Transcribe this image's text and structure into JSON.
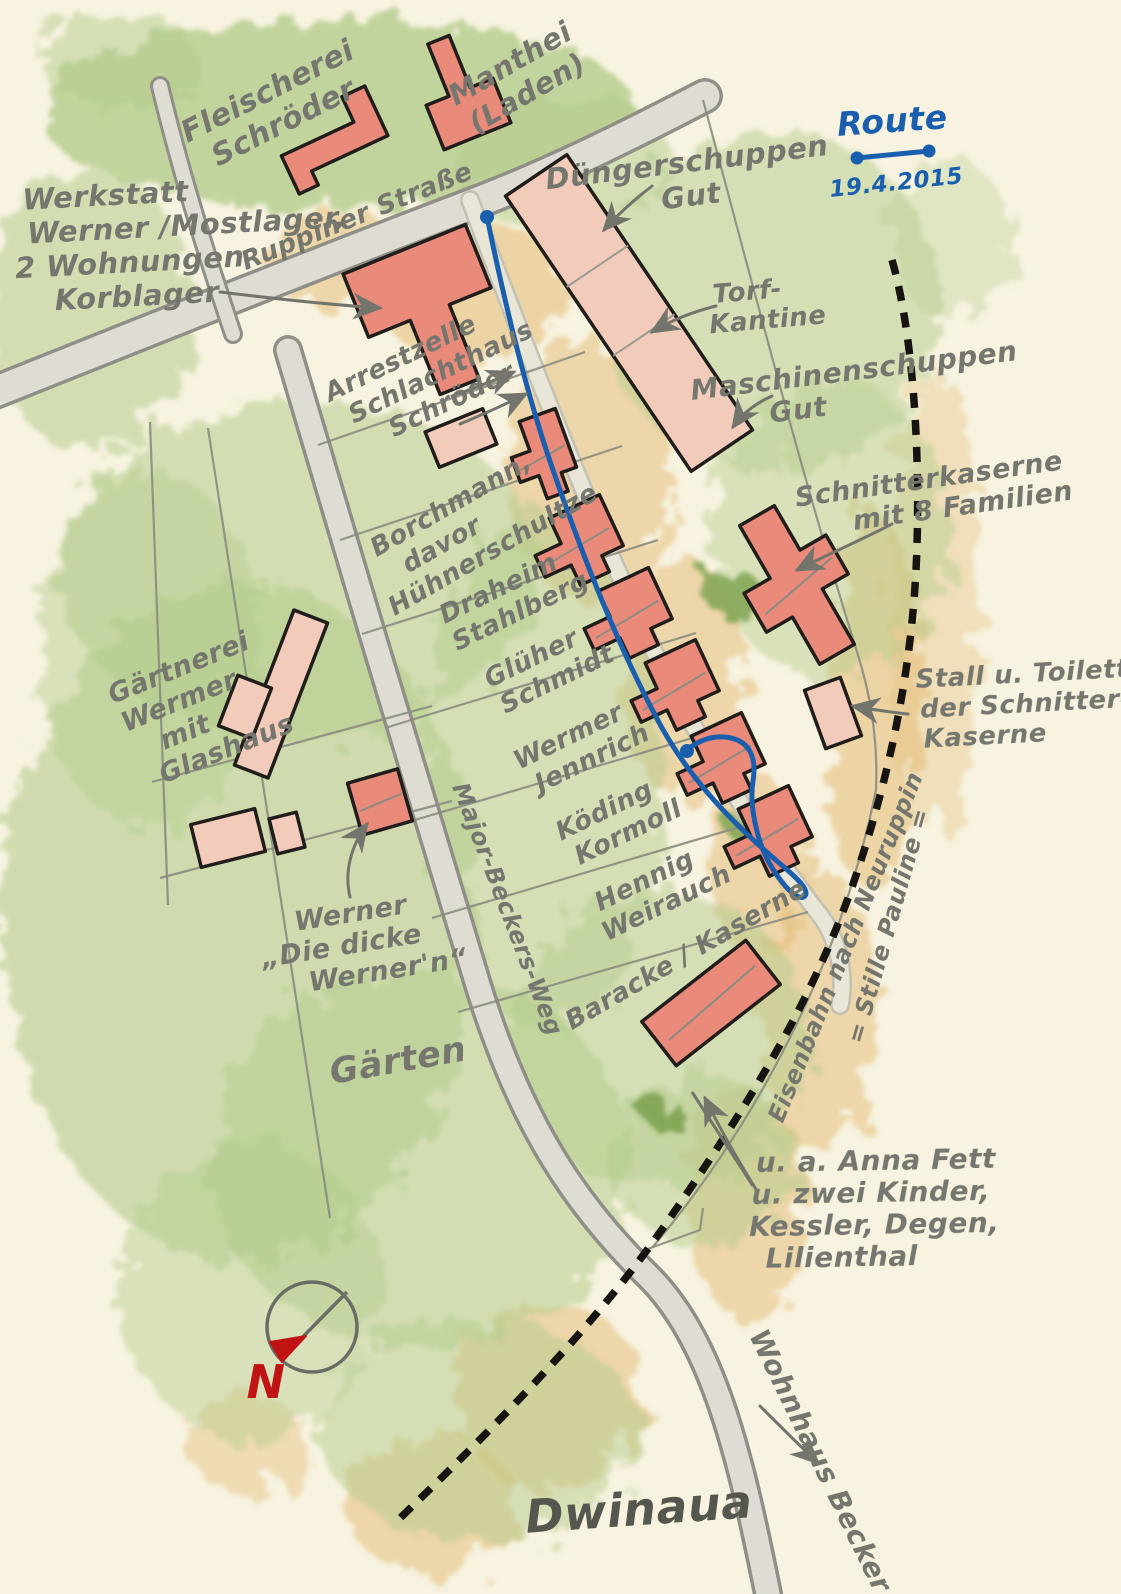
{
  "palette": {
    "paper": "#f7f3e0",
    "ink": "#75776f",
    "ink_dark": "#55574f",
    "blue": "#1a5fae",
    "red_pen": "#c01414",
    "outline": "#201d1a",
    "red": "#e98a7b",
    "pale": "#f2cbbb",
    "road_edge": "#8f8f88",
    "road_fill": "#dedcd3",
    "lane_edge": "#c2c1b3",
    "lane_fill": "#e9e6d8",
    "boundary": "#8a8c80",
    "rail": "#161310",
    "green": "#b4cc8c",
    "green_dark": "#7fa352",
    "tan": "#e3ba72",
    "arrow": "#73756d"
  },
  "legend": {
    "title": "Route",
    "date": "19.4.2015",
    "line": {
      "x1": 857,
      "y1": 158,
      "x2": 929,
      "y2": 151,
      "dot_r": 6.5
    }
  },
  "compass": {
    "cx": 312,
    "cy": 1327,
    "r": 45,
    "needle": {
      "x1": 347,
      "y1": 1292,
      "x2": 286,
      "y2": 1354
    },
    "arrowhead": "306,1336 282,1362 270,1342",
    "north_label": "N"
  },
  "labels": [
    {
      "id": "fleischerei",
      "lines": [
        "Fleischerei",
        "Schröder"
      ],
      "x": 272,
      "y": 100,
      "rot": -27,
      "size": 30
    },
    {
      "id": "manthei",
      "lines": [
        "Manthei",
        "(Laden)"
      ],
      "x": 515,
      "y": 72,
      "rot": -30,
      "size": 29
    },
    {
      "id": "werkstatt",
      "lines": [
        "Werkstatt",
        "Werner /Mostlager,",
        "2 Wohnungen",
        "Korblager"
      ],
      "x": 18,
      "y": 210,
      "rot": -3,
      "size": 29,
      "anchor": "start",
      "dxs": [
        5,
        8,
        -6,
        32
      ]
    },
    {
      "id": "ruppiner-strasse",
      "lines": [
        "Ruppiner Straße"
      ],
      "x": 360,
      "y": 224,
      "rot": -22,
      "size": 26
    },
    {
      "id": "duengerschuppen",
      "lines": [
        "Düngerschuppen",
        "Gut"
      ],
      "x": 688,
      "y": 172,
      "rot": -7,
      "size": 29
    },
    {
      "id": "torf-kantine",
      "lines": [
        "Torf-",
        "Kantine"
      ],
      "x": 748,
      "y": 300,
      "rot": -5,
      "size": 26,
      "dxs": [
        0,
        18
      ]
    },
    {
      "id": "maschinenschuppen",
      "lines": [
        "Maschinenschuppen",
        "Gut"
      ],
      "x": 855,
      "y": 380,
      "rot": -7,
      "size": 28,
      "dxs": [
        0,
        -60
      ]
    },
    {
      "id": "arrestzelle",
      "lines": [
        "Arrestzelle",
        "Schlachthaus",
        "Schröder"
      ],
      "x": 330,
      "y": 402,
      "rot": -26,
      "size": 26,
      "anchor": "start",
      "dxs": [
        0,
        12,
        42
      ]
    },
    {
      "id": "borchmann",
      "lines": [
        "Borchmann,",
        "davor",
        "Hühnerschultze"
      ],
      "x": 455,
      "y": 512,
      "rot": -30,
      "size": 26,
      "dxs": [
        0,
        -28,
        14
      ]
    },
    {
      "id": "draheim-stahlberg",
      "lines": [
        "Draheim",
        "Stahlberg"
      ],
      "x": 502,
      "y": 596,
      "rot": -26,
      "size": 26,
      "dxs": [
        0,
        10
      ]
    },
    {
      "id": "glueher-schmidt",
      "lines": [
        "Glüher",
        "Schmidt"
      ],
      "x": 535,
      "y": 666,
      "rot": -26,
      "size": 26,
      "dxs": [
        0,
        14
      ]
    },
    {
      "id": "wermer-jennrich",
      "lines": [
        "Wermer",
        "Jennrich"
      ],
      "x": 572,
      "y": 744,
      "rot": -26,
      "size": 26,
      "dxs": [
        0,
        12
      ]
    },
    {
      "id": "koeding-kormoll",
      "lines": [
        "Köding",
        "Kormoll"
      ],
      "x": 608,
      "y": 818,
      "rot": -26,
      "size": 26,
      "dxs": [
        0,
        12
      ]
    },
    {
      "id": "hennig-weirauch",
      "lines": [
        "Hennig",
        "Weirauch"
      ],
      "x": 648,
      "y": 888,
      "rot": -26,
      "size": 26,
      "dxs": [
        0,
        10
      ]
    },
    {
      "id": "baracke-kaserne",
      "lines": [
        "Baracke / Kaserne"
      ],
      "x": 690,
      "y": 962,
      "rot": -30,
      "size": 26
    },
    {
      "id": "schnitterkaserne",
      "lines": [
        "Schnitterkaserne",
        "mit 8 Familien"
      ],
      "x": 930,
      "y": 488,
      "rot": -8,
      "size": 27,
      "dxs": [
        0,
        30
      ]
    },
    {
      "id": "stall-toiletten",
      "lines": [
        "Stall u. Toiletten",
        "der Schnitter-",
        "Kaserne"
      ],
      "x": 916,
      "y": 688,
      "rot": -3,
      "size": 26,
      "anchor": "start",
      "dxs": [
        0,
        3,
        5
      ]
    },
    {
      "id": "gaertnerei",
      "lines": [
        "Gärtnerei",
        "Wermer",
        "mit",
        "Glashaus"
      ],
      "x": 182,
      "y": 676,
      "rot": -22,
      "size": 27,
      "dxs": [
        0,
        -12,
        -18,
        14
      ]
    },
    {
      "id": "dicke-wernern",
      "lines": [
        "Werner",
        "„Die dicke",
        "Werner'n“"
      ],
      "x": 352,
      "y": 922,
      "rot": -9,
      "size": 27,
      "dxs": [
        0,
        -14,
        28
      ]
    },
    {
      "id": "gaerten",
      "lines": [
        "Gärten"
      ],
      "x": 400,
      "y": 1072,
      "rot": -10,
      "size": 35
    },
    {
      "id": "major-beckers-weg",
      "lines": [
        "Major-Beckers-Weg"
      ],
      "x": 500,
      "y": 912,
      "rot": 69,
      "size": 24
    },
    {
      "id": "eisenbahn",
      "lines": [
        "Eisenbahn nach Neuruppin"
      ],
      "x": 853,
      "y": 950,
      "rot": -68,
      "size": 24
    },
    {
      "id": "stille-pauline",
      "lines": [
        "= Stille Pauline ="
      ],
      "x": 896,
      "y": 928,
      "rot": -74,
      "size": 24
    },
    {
      "id": "anna-fett",
      "lines": [
        "u. a. Anna Fett",
        "u. zwei Kinder,",
        "Kessler, Degen,",
        "Lilienthal"
      ],
      "x": 748,
      "y": 1172,
      "rot": -1,
      "size": 28,
      "anchor": "start",
      "dxs": [
        8,
        3,
        0,
        16
      ]
    },
    {
      "id": "wohnhaus-becker",
      "lines": [
        "Wohnhaus Becker"
      ],
      "x": 812,
      "y": 1465,
      "rot": 64,
      "size": 28
    },
    {
      "id": "dwinaua",
      "lines": [
        "Dwinaua"
      ],
      "x": 640,
      "y": 1525,
      "rot": -4,
      "size": 46,
      "color": "#55574f"
    },
    {
      "id": "route-title",
      "lines": [
        "Route"
      ],
      "x": 893,
      "y": 132,
      "rot": -4,
      "size": 33,
      "color": "#1a5fae"
    },
    {
      "id": "route-date",
      "lines": [
        "19.4.2015"
      ],
      "x": 897,
      "y": 190,
      "rot": -6,
      "size": 23,
      "color": "#1a5fae"
    },
    {
      "id": "compass-n",
      "lines": [
        "N"
      ],
      "x": 266,
      "y": 1398,
      "rot": 0,
      "size": 46,
      "color": "#c01414"
    }
  ],
  "shapes": {
    "rect": [
      [
        -0.5,
        -0.5
      ],
      [
        0.5,
        -0.5
      ],
      [
        0.5,
        0.5
      ],
      [
        -0.5,
        0.5
      ]
    ],
    "lhouse": [
      [
        -0.5,
        -0.12
      ],
      [
        -0.16,
        -0.12
      ],
      [
        -0.16,
        -0.5
      ],
      [
        0.5,
        -0.5
      ],
      [
        0.5,
        0.26
      ],
      [
        0.22,
        0.26
      ],
      [
        0.22,
        0.5
      ],
      [
        -0.16,
        0.5
      ],
      [
        -0.16,
        0.2
      ],
      [
        -0.5,
        0.2
      ]
    ],
    "tee": [
      [
        -0.5,
        -0.5
      ],
      [
        0.5,
        -0.5
      ],
      [
        0.5,
        -0.04
      ],
      [
        0.16,
        -0.04
      ],
      [
        0.16,
        0.5
      ],
      [
        -0.16,
        0.5
      ],
      [
        -0.16,
        -0.04
      ],
      [
        -0.5,
        -0.04
      ]
    ],
    "cross": [
      [
        -0.2,
        -0.5
      ],
      [
        0.2,
        -0.5
      ],
      [
        0.2,
        -0.18
      ],
      [
        0.5,
        -0.18
      ],
      [
        0.5,
        0.1
      ],
      [
        0.2,
        0.1
      ],
      [
        0.2,
        0.5
      ],
      [
        -0.2,
        0.5
      ],
      [
        -0.2,
        0.16
      ],
      [
        -0.5,
        0.16
      ],
      [
        -0.5,
        -0.12
      ],
      [
        -0.2,
        -0.12
      ]
    ],
    "barstep": [
      [
        -0.5,
        -0.1
      ],
      [
        0.26,
        -0.1
      ],
      [
        0.26,
        -0.5
      ],
      [
        0.5,
        -0.5
      ],
      [
        0.5,
        0.28
      ],
      [
        -0.3,
        0.28
      ],
      [
        -0.3,
        0.5
      ],
      [
        -0.5,
        0.5
      ]
    ]
  },
  "buildings": [
    {
      "id": "fleischerei-schroeder",
      "shape": "barstep",
      "cx": 332,
      "cy": 140,
      "w": 105,
      "h": 70,
      "rot": -25,
      "tone": "red"
    },
    {
      "id": "manthei-laden",
      "shape": "tee",
      "cx": 458,
      "cy": 88,
      "w": 72,
      "h": 104,
      "rot": 158,
      "tone": "red"
    },
    {
      "id": "werkstatt-schlachthaus",
      "shape": "tee",
      "cx": 432,
      "cy": 318,
      "w": 132,
      "h": 148,
      "rot": -22,
      "tone": "red"
    },
    {
      "id": "duengerschuppen-gut",
      "shape": "rect",
      "cx": 629,
      "cy": 313,
      "w": 74,
      "h": 332,
      "rot": -34,
      "tone": "pale",
      "partitions": [
        0.33,
        0.58
      ]
    },
    {
      "id": "huehner-shed",
      "shape": "rect",
      "cx": 461,
      "cy": 438,
      "w": 62,
      "h": 38,
      "rot": -22,
      "tone": "pale"
    },
    {
      "id": "borchmann-haus",
      "shape": "lhouse",
      "cx": 542,
      "cy": 457,
      "w": 58,
      "h": 82,
      "rot": -20,
      "tone": "red",
      "ridge": true
    },
    {
      "id": "row-haus-1",
      "shape": "lhouse",
      "cx": 577,
      "cy": 546,
      "w": 84,
      "h": 74,
      "rot": -25,
      "tone": "red",
      "ridge": true
    },
    {
      "id": "row-haus-2",
      "shape": "lhouse",
      "cx": 626,
      "cy": 619,
      "w": 84,
      "h": 74,
      "rot": -25,
      "tone": "red",
      "ridge": true
    },
    {
      "id": "row-haus-3",
      "shape": "lhouse",
      "cx": 673,
      "cy": 691,
      "w": 84,
      "h": 74,
      "rot": -25,
      "tone": "red",
      "ridge": true
    },
    {
      "id": "row-haus-4",
      "shape": "lhouse",
      "cx": 719,
      "cy": 764,
      "w": 84,
      "h": 74,
      "rot": -25,
      "tone": "red",
      "ridge": true
    },
    {
      "id": "row-haus-5",
      "shape": "lhouse",
      "cx": 766,
      "cy": 837,
      "w": 84,
      "h": 74,
      "rot": -25,
      "tone": "red",
      "ridge": true
    },
    {
      "id": "schnitterkaserne",
      "shape": "cross",
      "cx": 797,
      "cy": 585,
      "w": 100,
      "h": 160,
      "rot": -30,
      "tone": "red",
      "ridge": true
    },
    {
      "id": "stall-toiletten-shed",
      "shape": "rect",
      "cx": 833,
      "cy": 713,
      "w": 38,
      "h": 62,
      "rot": -20,
      "tone": "pale"
    },
    {
      "id": "baracke",
      "shape": "rect",
      "cx": 711,
      "cy": 1003,
      "w": 132,
      "h": 56,
      "rot": -38,
      "tone": "red",
      "ridge": true
    },
    {
      "id": "glashaus",
      "shape": "rect",
      "cx": 281,
      "cy": 694,
      "w": 36,
      "h": 166,
      "rot": 21,
      "tone": "pale"
    },
    {
      "id": "gaertnerei-shed",
      "shape": "rect",
      "cx": 245,
      "cy": 707,
      "w": 36,
      "h": 54,
      "rot": 21,
      "tone": "pale"
    },
    {
      "id": "pale-barn",
      "shape": "rect",
      "cx": 228,
      "cy": 838,
      "w": 66,
      "h": 44,
      "rot": -14,
      "tone": "pale"
    },
    {
      "id": "pale-hut",
      "shape": "rect",
      "cx": 287,
      "cy": 833,
      "w": 28,
      "h": 36,
      "rot": -14,
      "tone": "pale"
    },
    {
      "id": "dicke-werner-haus",
      "shape": "rect",
      "cx": 380,
      "cy": 802,
      "w": 52,
      "h": 54,
      "rot": -16,
      "tone": "red",
      "ridge": true
    }
  ],
  "roads": [
    {
      "id": "ruppiner-strasse",
      "d": "M -20,398 C 150,330 320,262 470,205 C 550,175 630,135 705,96",
      "w_out": 36,
      "w_in": 29
    },
    {
      "id": "nord-stub",
      "d": "M 160,86 C 180,170 205,250 233,334",
      "w_out": 20,
      "w_in": 14
    },
    {
      "id": "major-beckers-weg",
      "d": "M 288,350 C 345,545 425,810 478,985 C 520,1122 575,1205 648,1276 C 715,1342 742,1465 768,1594",
      "w_out": 30,
      "w_in": 23
    },
    {
      "id": "gut-lane",
      "d": "M 470,200 C 515,320 575,475 638,618 C 692,735 758,835 822,918 C 838,940 846,975 840,1005",
      "w_out": 20,
      "w_in": 15,
      "lane": true
    }
  ],
  "boundaries": [
    {
      "id": "plot-1",
      "d": "M 318,445 L 585,352"
    },
    {
      "id": "plot-2",
      "d": "M 340,540 L 622,446"
    },
    {
      "id": "plot-3",
      "d": "M 362,634 L 658,540"
    },
    {
      "id": "plot-4",
      "d": "M 385,728 L 696,633"
    },
    {
      "id": "plot-5",
      "d": "M 408,822 L 733,726"
    },
    {
      "id": "plot-6",
      "d": "M 432,918 L 770,818"
    },
    {
      "id": "plot-7",
      "d": "M 458,1012 L 808,912"
    },
    {
      "id": "garten-quer-1",
      "d": "M 152,782 L 432,706"
    },
    {
      "id": "garten-quer-2",
      "d": "M 160,878 L 452,801"
    },
    {
      "id": "garten-west",
      "d": "M 150,422 L 168,905"
    },
    {
      "id": "garten-lang",
      "d": "M 208,428 L 330,1218"
    },
    {
      "id": "gut-ost",
      "d": "M 703,100 C 745,255 800,470 858,655"
    },
    {
      "id": "gut-ost-2",
      "d": "M 858,655 C 872,700 878,745 876,790"
    },
    {
      "id": "bahn-west",
      "d": "M 876,790 C 842,958 760,1120 652,1248"
    },
    {
      "id": "kreuzung-zacke",
      "d": "M 645,1250 L 700,1230 L 703,1208"
    }
  ],
  "railway": {
    "id": "eisenbahn-gleis",
    "d": "M 892,260 C 912,330 920,440 917,545 C 914,655 893,770 851,890 C 809,1008 744,1112 663,1228 C 595,1325 500,1422 396,1522",
    "width": 7.5,
    "dash": "15 12"
  },
  "route": {
    "d": "M 487,217 C 502,290 525,390 553,470 C 585,563 622,655 662,728 C 698,792 748,836 778,862 C 796,877 810,890 805,896 C 799,902 784,888 771,866 C 757,843 749,805 753,781 C 757,757 749,742 731,738 C 712,734 696,742 687,750",
    "width": 5,
    "start": {
      "x": 487,
      "y": 217,
      "r": 7
    },
    "end": {
      "x": 687,
      "y": 751,
      "r": 7
    }
  },
  "arrows": [
    {
      "id": "werkstatt-arrow",
      "d": "M 220,292 C 285,300 335,305 380,308"
    },
    {
      "id": "arrest-arrow-1",
      "d": "M 452,396 C 475,388 495,380 514,372"
    },
    {
      "id": "arrest-arrow-2",
      "d": "M 460,424 C 484,414 506,404 526,394"
    },
    {
      "id": "duenger-arrow",
      "d": "M 652,186 C 634,200 618,214 604,230"
    },
    {
      "id": "torf-arrow",
      "d": "M 716,306 C 692,312 670,321 652,332"
    },
    {
      "id": "maschinen-arrow",
      "d": "M 772,396 C 754,404 742,414 733,427"
    },
    {
      "id": "schnitter-arrow",
      "d": "M 892,524 C 855,543 820,558 797,570"
    },
    {
      "id": "stall-arrow",
      "d": "M 908,714 C 888,712 870,709 853,706"
    },
    {
      "id": "dicke-arrow",
      "d": "M 350,897 C 344,872 351,846 367,824"
    },
    {
      "id": "annafett-arrow",
      "d": "M 757,1191 C 736,1157 719,1127 705,1098"
    },
    {
      "id": "becker-arrow",
      "d": "M 760,1406 C 780,1426 800,1446 818,1463"
    }
  ],
  "slash": {
    "id": "bahn-slash",
    "d": "M 692,1092 L 753,1186"
  },
  "patches": {
    "green": [
      [
        340,
        115,
        300,
        95,
        0.8
      ],
      [
        120,
        60,
        80,
        50,
        0.5
      ],
      [
        90,
        310,
        105,
        140,
        0.55
      ],
      [
        560,
        160,
        110,
        70,
        0.5
      ],
      [
        770,
        300,
        170,
        170,
        0.5
      ],
      [
        830,
        530,
        120,
        150,
        0.45
      ],
      [
        300,
        570,
        240,
        170,
        0.55
      ],
      [
        240,
        920,
        240,
        340,
        0.6
      ],
      [
        150,
        650,
        110,
        180,
        0.45
      ],
      [
        420,
        1160,
        210,
        190,
        0.55
      ],
      [
        545,
        770,
        120,
        260,
        0.5
      ],
      [
        660,
        1040,
        150,
        150,
        0.5
      ],
      [
        480,
        1430,
        160,
        110,
        0.5
      ],
      [
        250,
        1290,
        130,
        150,
        0.45
      ],
      [
        705,
        1160,
        95,
        85,
        0.5
      ],
      [
        950,
        240,
        60,
        80,
        0.35
      ]
    ],
    "green_dark": [
      [
        735,
        595,
        30,
        22,
        0.85
      ],
      [
        757,
        832,
        26,
        18,
        0.85
      ],
      [
        663,
        1113,
        20,
        15,
        0.9
      ]
    ],
    "tan": [
      [
        470,
        292,
        95,
        70,
        0.55
      ],
      [
        590,
        470,
        85,
        130,
        0.5
      ],
      [
        682,
        680,
        62,
        120,
        0.5
      ],
      [
        756,
        868,
        48,
        95,
        0.5
      ],
      [
        872,
        700,
        48,
        190,
        0.55
      ],
      [
        818,
        1010,
        58,
        145,
        0.5
      ],
      [
        748,
        1205,
        58,
        115,
        0.5
      ],
      [
        548,
        1395,
        95,
        95,
        0.5
      ],
      [
        432,
        1505,
        85,
        70,
        0.5
      ],
      [
        935,
        600,
        45,
        230,
        0.35
      ],
      [
        338,
        262,
        68,
        48,
        0.5
      ],
      [
        248,
        1445,
        60,
        50,
        0.4
      ]
    ]
  }
}
